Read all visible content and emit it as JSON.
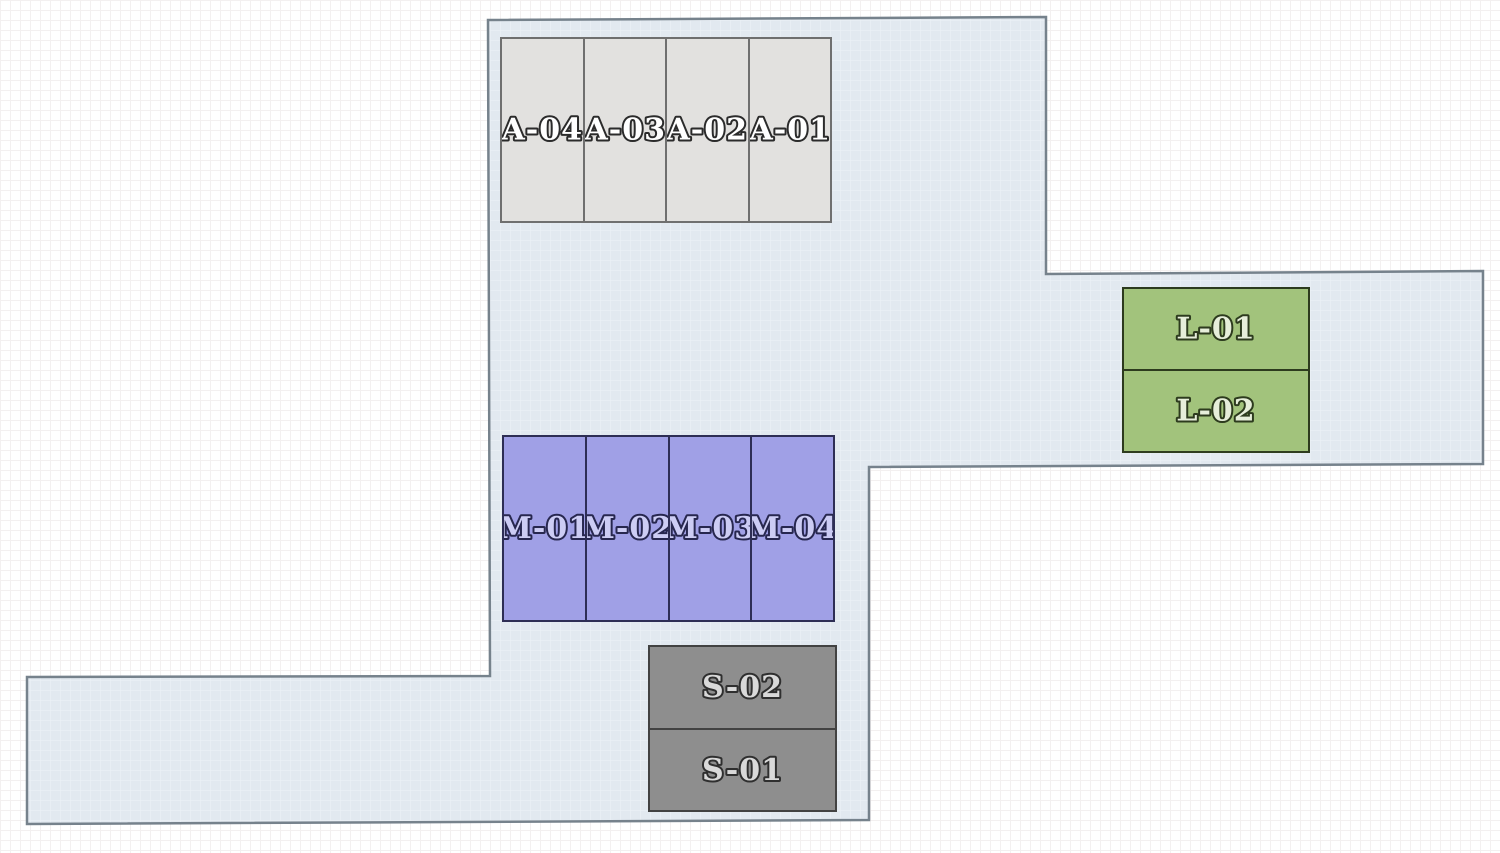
{
  "plan": {
    "name": "lot-site-plan",
    "colors": {
      "page_background": "#ffffff",
      "page_grid": "#f3f0f0",
      "site_fill": "#e2e9f0",
      "site_grid": "#edf2f7",
      "site_border": "#76828c",
      "group_a_fill": "#e2e1df",
      "group_a_border": "#6f6f6f",
      "group_a_text": "#ffffff",
      "group_a_text_outline": "#2b2b2b",
      "group_m_fill": "#a0a0e6",
      "group_m_border": "#2e2e55",
      "group_m_text": "#ccccf4",
      "group_m_text_outline": "#27274f",
      "group_l_fill": "#a2c37c",
      "group_l_border": "#2d3b1e",
      "group_l_text": "#e6eeda",
      "group_l_text_outline": "#2d3b1e",
      "group_s_fill": "#8e8e8e",
      "group_s_border": "#424242",
      "group_s_text": "#d9d9d9",
      "group_s_text_outline": "#2f2f2f"
    },
    "groups": {
      "a": {
        "orientation": "columns",
        "units": [
          {
            "label": "A-04"
          },
          {
            "label": "A-03"
          },
          {
            "label": "A-02"
          },
          {
            "label": "A-01"
          }
        ]
      },
      "m": {
        "orientation": "columns",
        "units": [
          {
            "label": "M-01"
          },
          {
            "label": "M-02"
          },
          {
            "label": "M-03"
          },
          {
            "label": "M-04"
          }
        ]
      },
      "l": {
        "orientation": "rows",
        "units": [
          {
            "label": "L-01"
          },
          {
            "label": "L-02"
          }
        ]
      },
      "s": {
        "orientation": "rows",
        "units": [
          {
            "label": "S-02"
          },
          {
            "label": "S-01"
          }
        ]
      }
    }
  }
}
